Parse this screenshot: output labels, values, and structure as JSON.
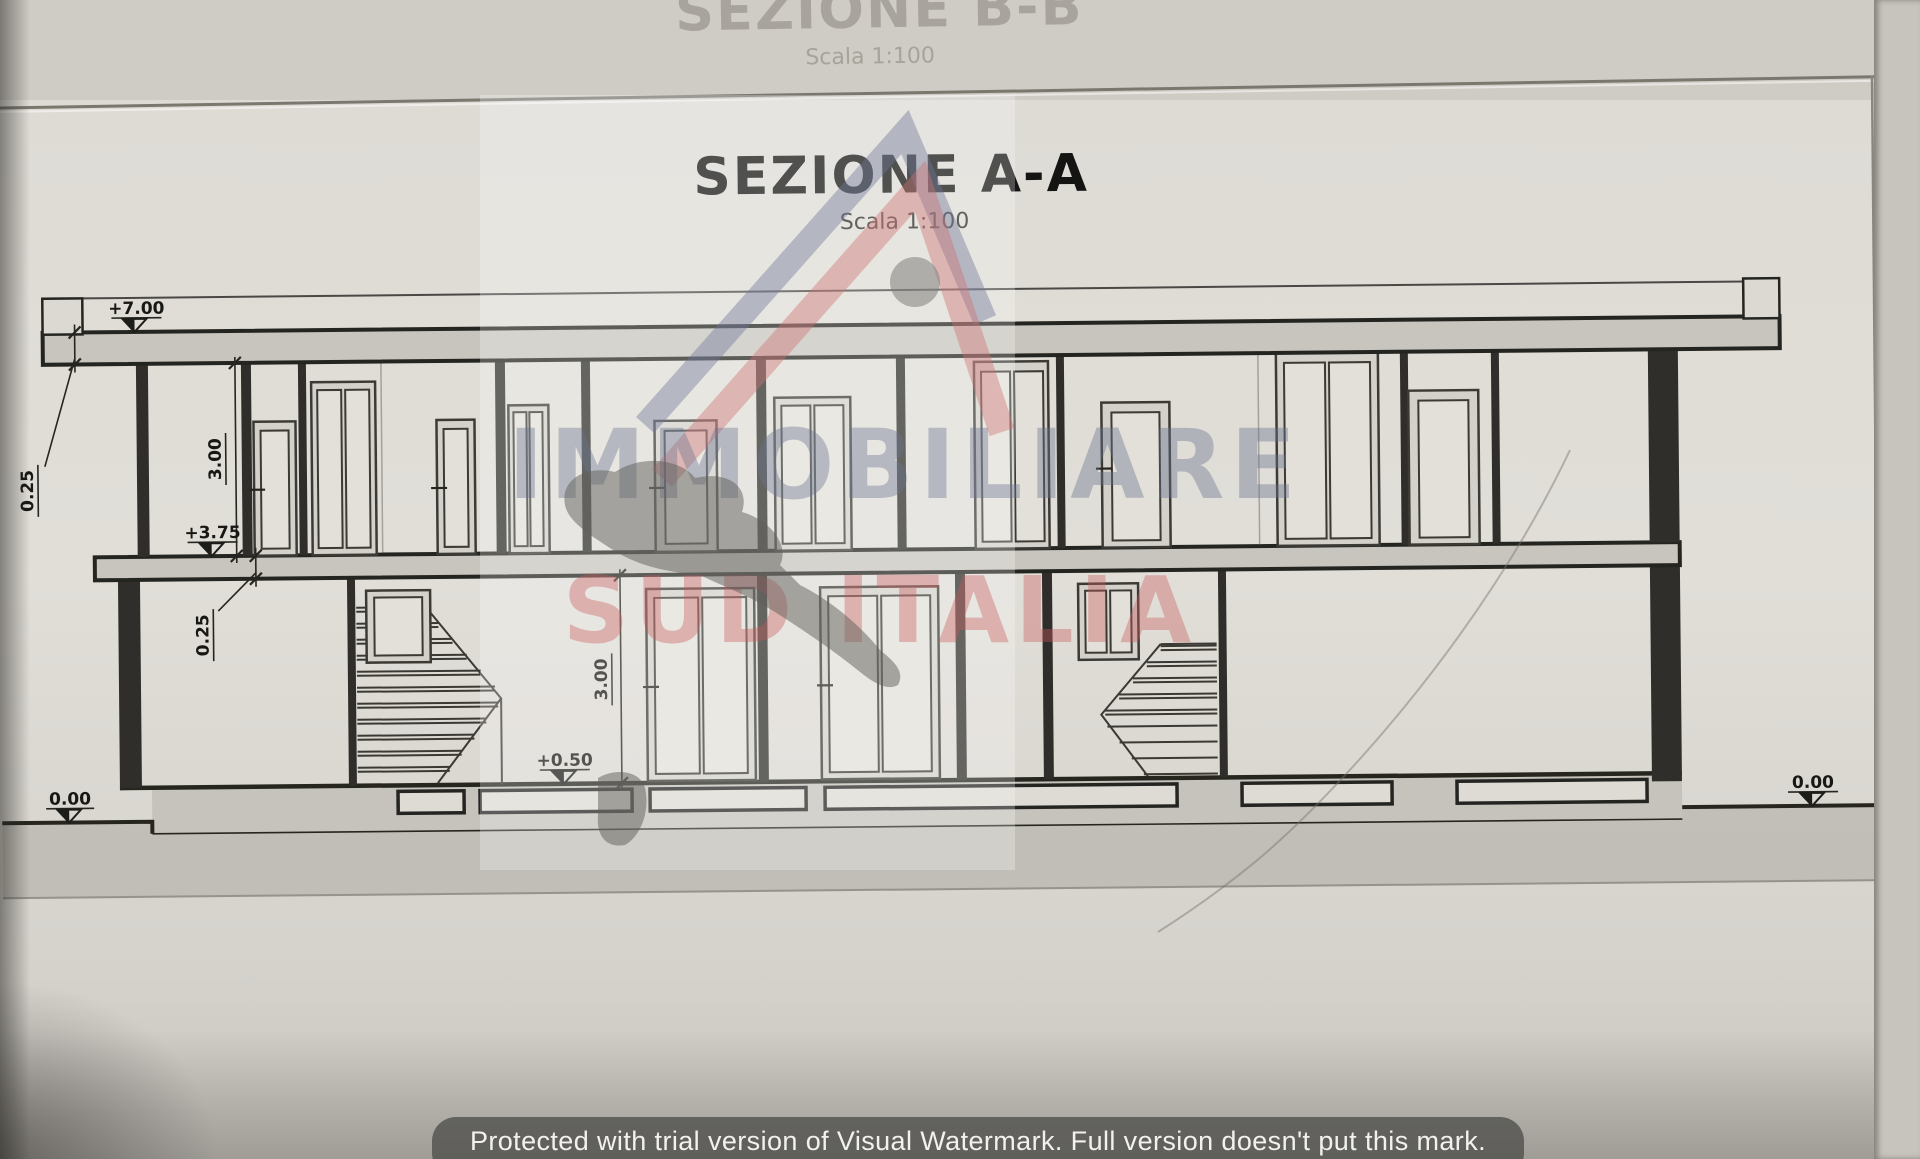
{
  "page": {
    "title": "SEZIONE  A-A",
    "scale_note": "Scala 1:100",
    "background_title": "SEZIONE  B-B",
    "background_scale_note": "Scala 1:100"
  },
  "dimensions": {
    "roof_level": "+7.00",
    "roof_slab_thickness": "0.25",
    "upper_floor_height": "3.00",
    "first_floor_level": "+3.75",
    "floor_slab_thickness": "0.25",
    "ground_floor_height": "3.00",
    "ground_floor_level": "+0.50",
    "grade_level_left": "0.00",
    "grade_level_right": "0.00"
  },
  "watermark": {
    "brand_line1": "IMMOBILIARE",
    "brand_line2": "SUD ITALIA",
    "banner_text": "Protected with trial version of Visual Watermark. Full version doesn't put this mark.",
    "colors": {
      "brand_blue": "#6e7a98",
      "brand_red": "#c86a6a",
      "banner_background": "#52524e",
      "logo_head_gray": "#82807c"
    }
  },
  "drawing_style": {
    "ink": "#26261f",
    "slab_fill": "#c8c5bf",
    "paper": "#dcd9d3"
  }
}
